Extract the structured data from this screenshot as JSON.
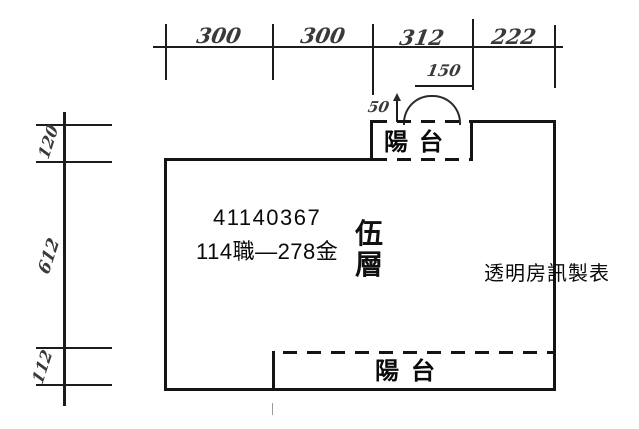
{
  "colors": {
    "background": "#ffffff",
    "wall_line": "#141414",
    "dimension_line": "#1c1c1c",
    "handwriting": "#3a3a3a",
    "text": "#0a0a0a"
  },
  "top_dimension_row": {
    "segments": [
      {
        "label": "300"
      },
      {
        "label": "300"
      },
      {
        "label": "312"
      },
      {
        "label": "222"
      }
    ]
  },
  "detail_dimensions": {
    "balcony_door_width": "150",
    "door_offset": "50"
  },
  "left_dimension_column": {
    "segments": [
      {
        "label": "120"
      },
      {
        "label": "612"
      },
      {
        "label": "112"
      }
    ]
  },
  "floor_plan": {
    "registration_number": "41140367",
    "area_info": "114職—278金",
    "floor_label": "伍層",
    "floor_label_chars": [
      "伍",
      "層"
    ],
    "top_balcony_label": "陽台",
    "bottom_balcony_label": "陽台",
    "source_label": "透明房訊製表"
  }
}
